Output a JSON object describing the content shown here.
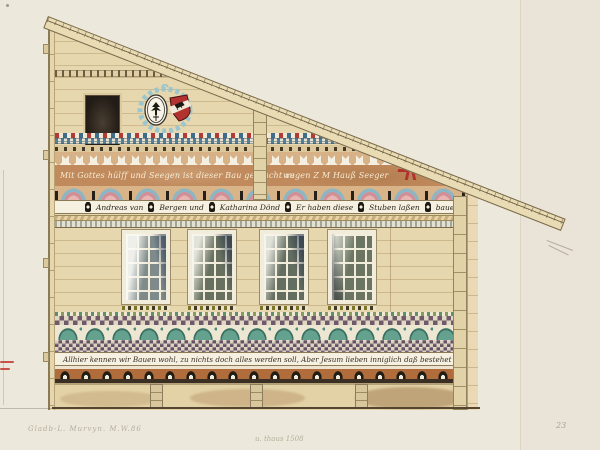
{
  "artwork": {
    "description": "Watercolor elevation drawing of a painted farmhouse facade with decorative friezes, coat of arms, four windows and inscription bands",
    "year_inscribed": "1775"
  },
  "inscriptions": {
    "blessing_band": {
      "left": "Mit Gottes hülff und Seegen ist dieser Bau gebracht zu",
      "right": "wegen Z M Hauß Seeger"
    },
    "family_band": {
      "segments": [
        "Andreas van",
        "Bergen  und",
        "Katharina Dönd",
        "Er haben diese",
        "Stuben laßen",
        "bauen hur Im 1775."
      ]
    },
    "motto_band": {
      "text": "Allhier kennen wir Bauen wohl, zu nichts doch alles werden soll, Aber Jesum lieben inniglich daß bestehet Ewiglich"
    },
    "pencil_notes": {
      "left": "Gladb-L.  Murvyn. M.W.86",
      "center": "u. thaus 1508",
      "page_number": "23"
    }
  },
  "facade": {
    "window_count": 4,
    "foundation_pier_count": 3,
    "crest": {
      "left_shield": "black eagle on white oval",
      "right_shield": "red shield with white bend and black bear",
      "wreath": "pale blue scrollwork"
    }
  },
  "palette": {
    "paper": "#ece8db",
    "wall_tan": "#e7d7ae",
    "inscription_brown": "#c08a5c",
    "accent_red": "#b23230",
    "accent_blue": "#86b7c2",
    "accent_pink": "#dfa3a6",
    "accent_teal": "#5f9c8a",
    "checker_plum": "#6f5a63",
    "roof_tan": "#e9dcb4"
  }
}
